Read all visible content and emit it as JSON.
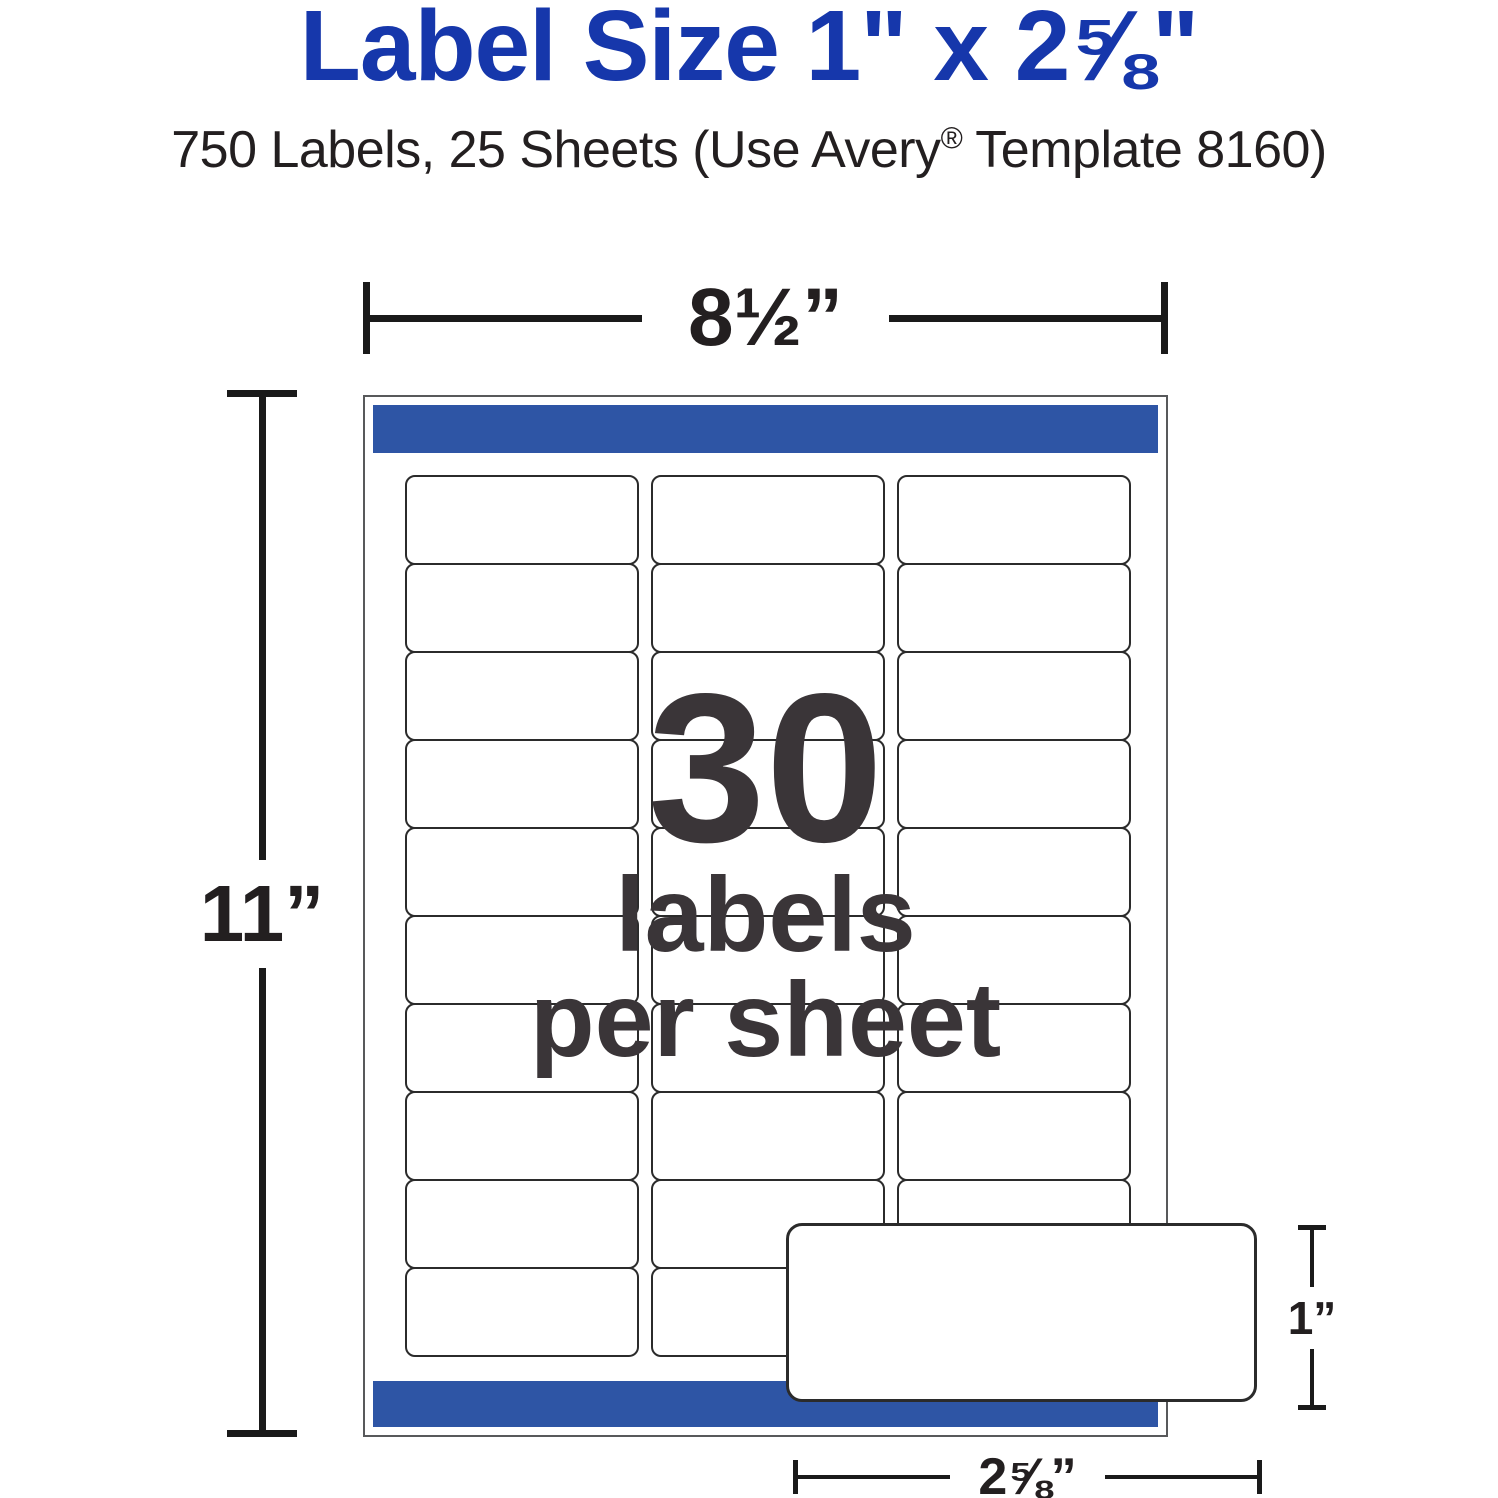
{
  "header": {
    "title": "Label Size 1\" x 2⅝\"",
    "subtitle_pre": "750 Labels, 25 Sheets (Use Avery",
    "subtitle_reg": "®",
    "subtitle_post": " Template 8160)"
  },
  "diagram": {
    "sheet_width_label": "8½”",
    "sheet_height_label": "11”",
    "label_height_label": "1”",
    "label_width_label": "2⅝”",
    "callout": {
      "count": "30",
      "line2": "labels",
      "line3": "per sheet"
    },
    "grid": {
      "columns": 3,
      "rows": 10,
      "total_labels": 30
    }
  },
  "colors": {
    "title_blue": "#1637ab",
    "bar_blue": "#2e55a5",
    "text_dark": "#231f20",
    "callout_text": "#3a3538"
  }
}
